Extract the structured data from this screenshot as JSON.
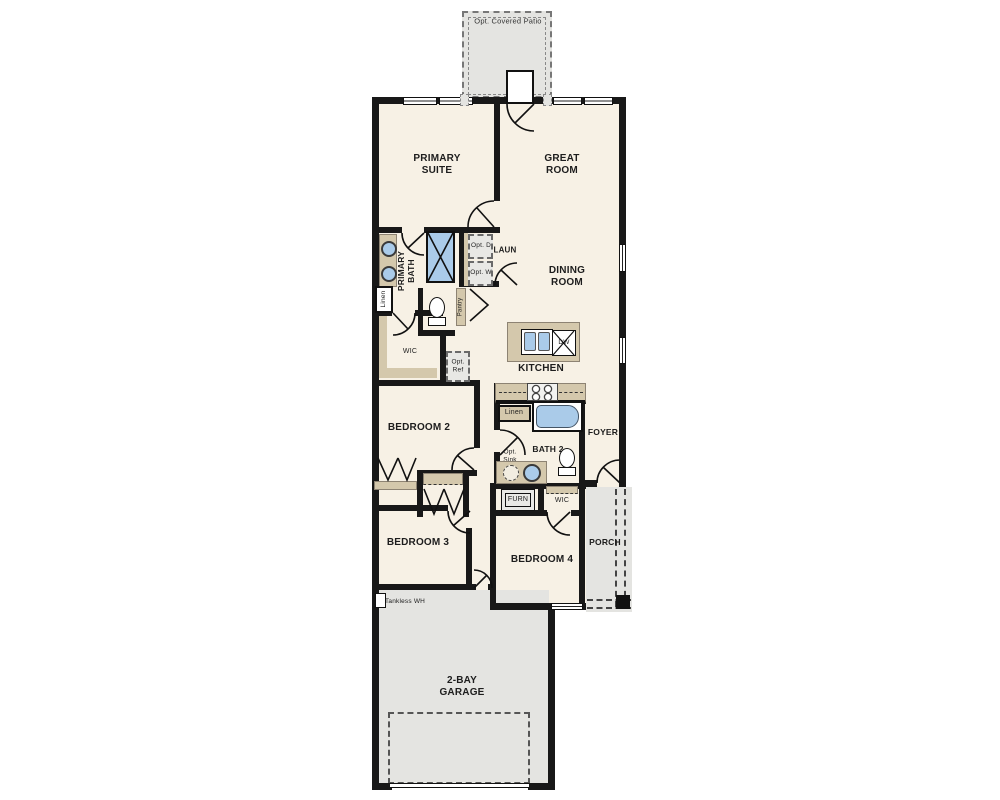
{
  "plan": {
    "labels": {
      "patio": "Opt. Covered Patio",
      "primary_suite": "PRIMARY SUITE",
      "great_room": "GREAT ROOM",
      "dining_room": "DINING ROOM",
      "kitchen": "KITCHEN",
      "primary_bath": "PRIMARY BATH",
      "laundry": "LAUN",
      "opt_dryer": "Opt. D",
      "opt_washer": "Opt. W",
      "linen_primary": "Linen",
      "pantry": "Pantry",
      "wic_primary": "WIC",
      "opt_fridge": "Opt. Ref",
      "dishwasher": "DW",
      "bedroom2": "BEDROOM 2",
      "bedroom3": "BEDROOM 3",
      "bedroom4": "BEDROOM 4",
      "bath2": "BATH 2",
      "linen_bath2": "Linen",
      "opt_sink": "Opt. Sink",
      "foyer": "FOYER",
      "furnace": "FURN",
      "wic_bedroom4": "WIC",
      "porch": "PORCH",
      "tankless_wh": "Tankless WH",
      "garage": "2-BAY GARAGE"
    },
    "colors": {
      "floor": "#f7f1e5",
      "outdoor": "#e4e4e1",
      "wall": "#181818",
      "cabinetry": "#d4c8ac",
      "water_fixture": "#aacbe9"
    }
  }
}
